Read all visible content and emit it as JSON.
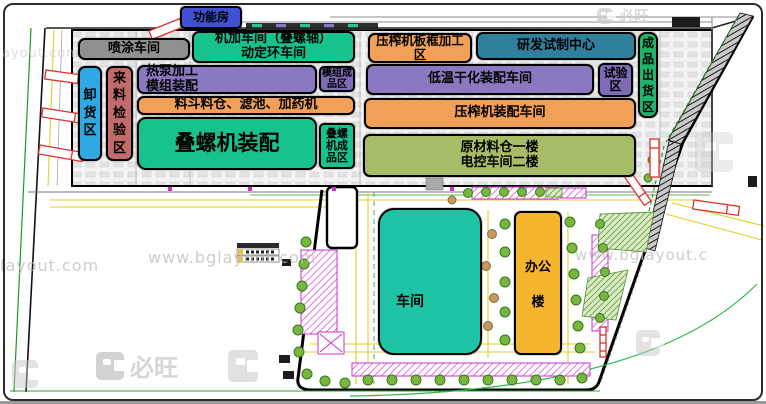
{
  "zones": {
    "function_room": {
      "label": "功能房",
      "color": "#3f51d2"
    },
    "spray_workshop": {
      "label": "喷涂车间",
      "color": "#909090"
    },
    "machining_workshop": {
      "label": "机加车间（叠螺轴）\n动定环车间",
      "color": "#17c28e"
    },
    "heat_pump_module": {
      "label": "热泵加工\n模组装配",
      "color": "#8a79c0"
    },
    "module_finished": {
      "label": "模组成\n品区",
      "color": "#7d6bb5"
    },
    "hopper_line": {
      "label": "料斗料仓、滤池、加药机",
      "color": "#f2a057"
    },
    "stacked_screw_assembly": {
      "label": "叠螺机装配",
      "color": "#17c28e"
    },
    "stacked_screw_finished": {
      "label": "叠螺\n机成\n品区",
      "color": "#17c28e"
    },
    "unloading_area": {
      "label": "卸货区",
      "color": "#2fa9e1"
    },
    "incoming_inspection": {
      "label": "来料检验区",
      "color": "#c36a6a"
    },
    "press_plate_frame": {
      "label": "压榨机板框加工\n区",
      "color": "#f2a057"
    },
    "rd_pilot_center": {
      "label": "研发试制中心",
      "color": "#2f7f9d"
    },
    "low_temp_drying": {
      "label": "低温干化装配车间",
      "color": "#8a79c0"
    },
    "test_area": {
      "label": "试验\n区",
      "color": "#7d6bb5"
    },
    "press_assembly": {
      "label": "压榨机装配车间",
      "color": "#f2a057"
    },
    "raw_material_warehouse": {
      "label": "原材料仓一楼\n电控车间二楼",
      "color": "#a6bc66"
    },
    "finished_shipping": {
      "label": "成品出货区",
      "color": "#22b26a"
    },
    "workshop_south": {
      "label": "车间",
      "color": "#1ec4a5"
    },
    "office_building": {
      "top": "办公",
      "bottom": "楼",
      "color": "#f6b52e"
    }
  },
  "watermarks": {
    "url_full": "www.bglayout.com",
    "url_left": "layout.com",
    "url_top_left": "ayout.com",
    "url_right": "www.bglayout.c",
    "brand": "必旺"
  }
}
